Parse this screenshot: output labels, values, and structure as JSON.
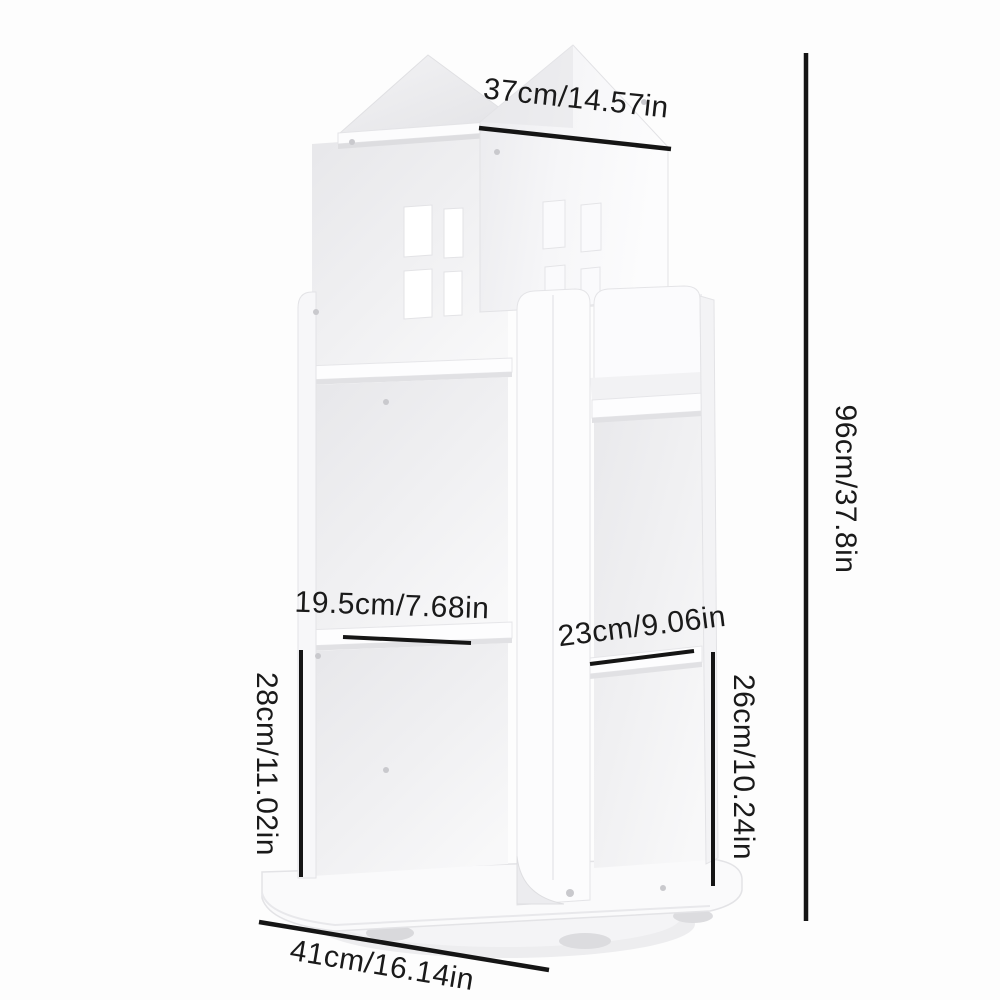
{
  "meta": {
    "type": "product-dimension-diagram",
    "subject": "white rotating house-shaped bookshelf",
    "background_color": "#fdfdfd",
    "product_color": "#ffffff",
    "line_color": "#151515",
    "text_color": "#1a1a1a"
  },
  "dimensions": {
    "top_width": "37cm/14.57in",
    "overall_height": "96cm/37.8in",
    "upper_left_shelf_width": "19.5cm/7.68in",
    "right_shelf_width": "23cm/9.06in",
    "left_compartment_height": "28cm/11.02in",
    "right_compartment_height": "26cm/10.24in",
    "base_width": "41cm/16.14in"
  }
}
